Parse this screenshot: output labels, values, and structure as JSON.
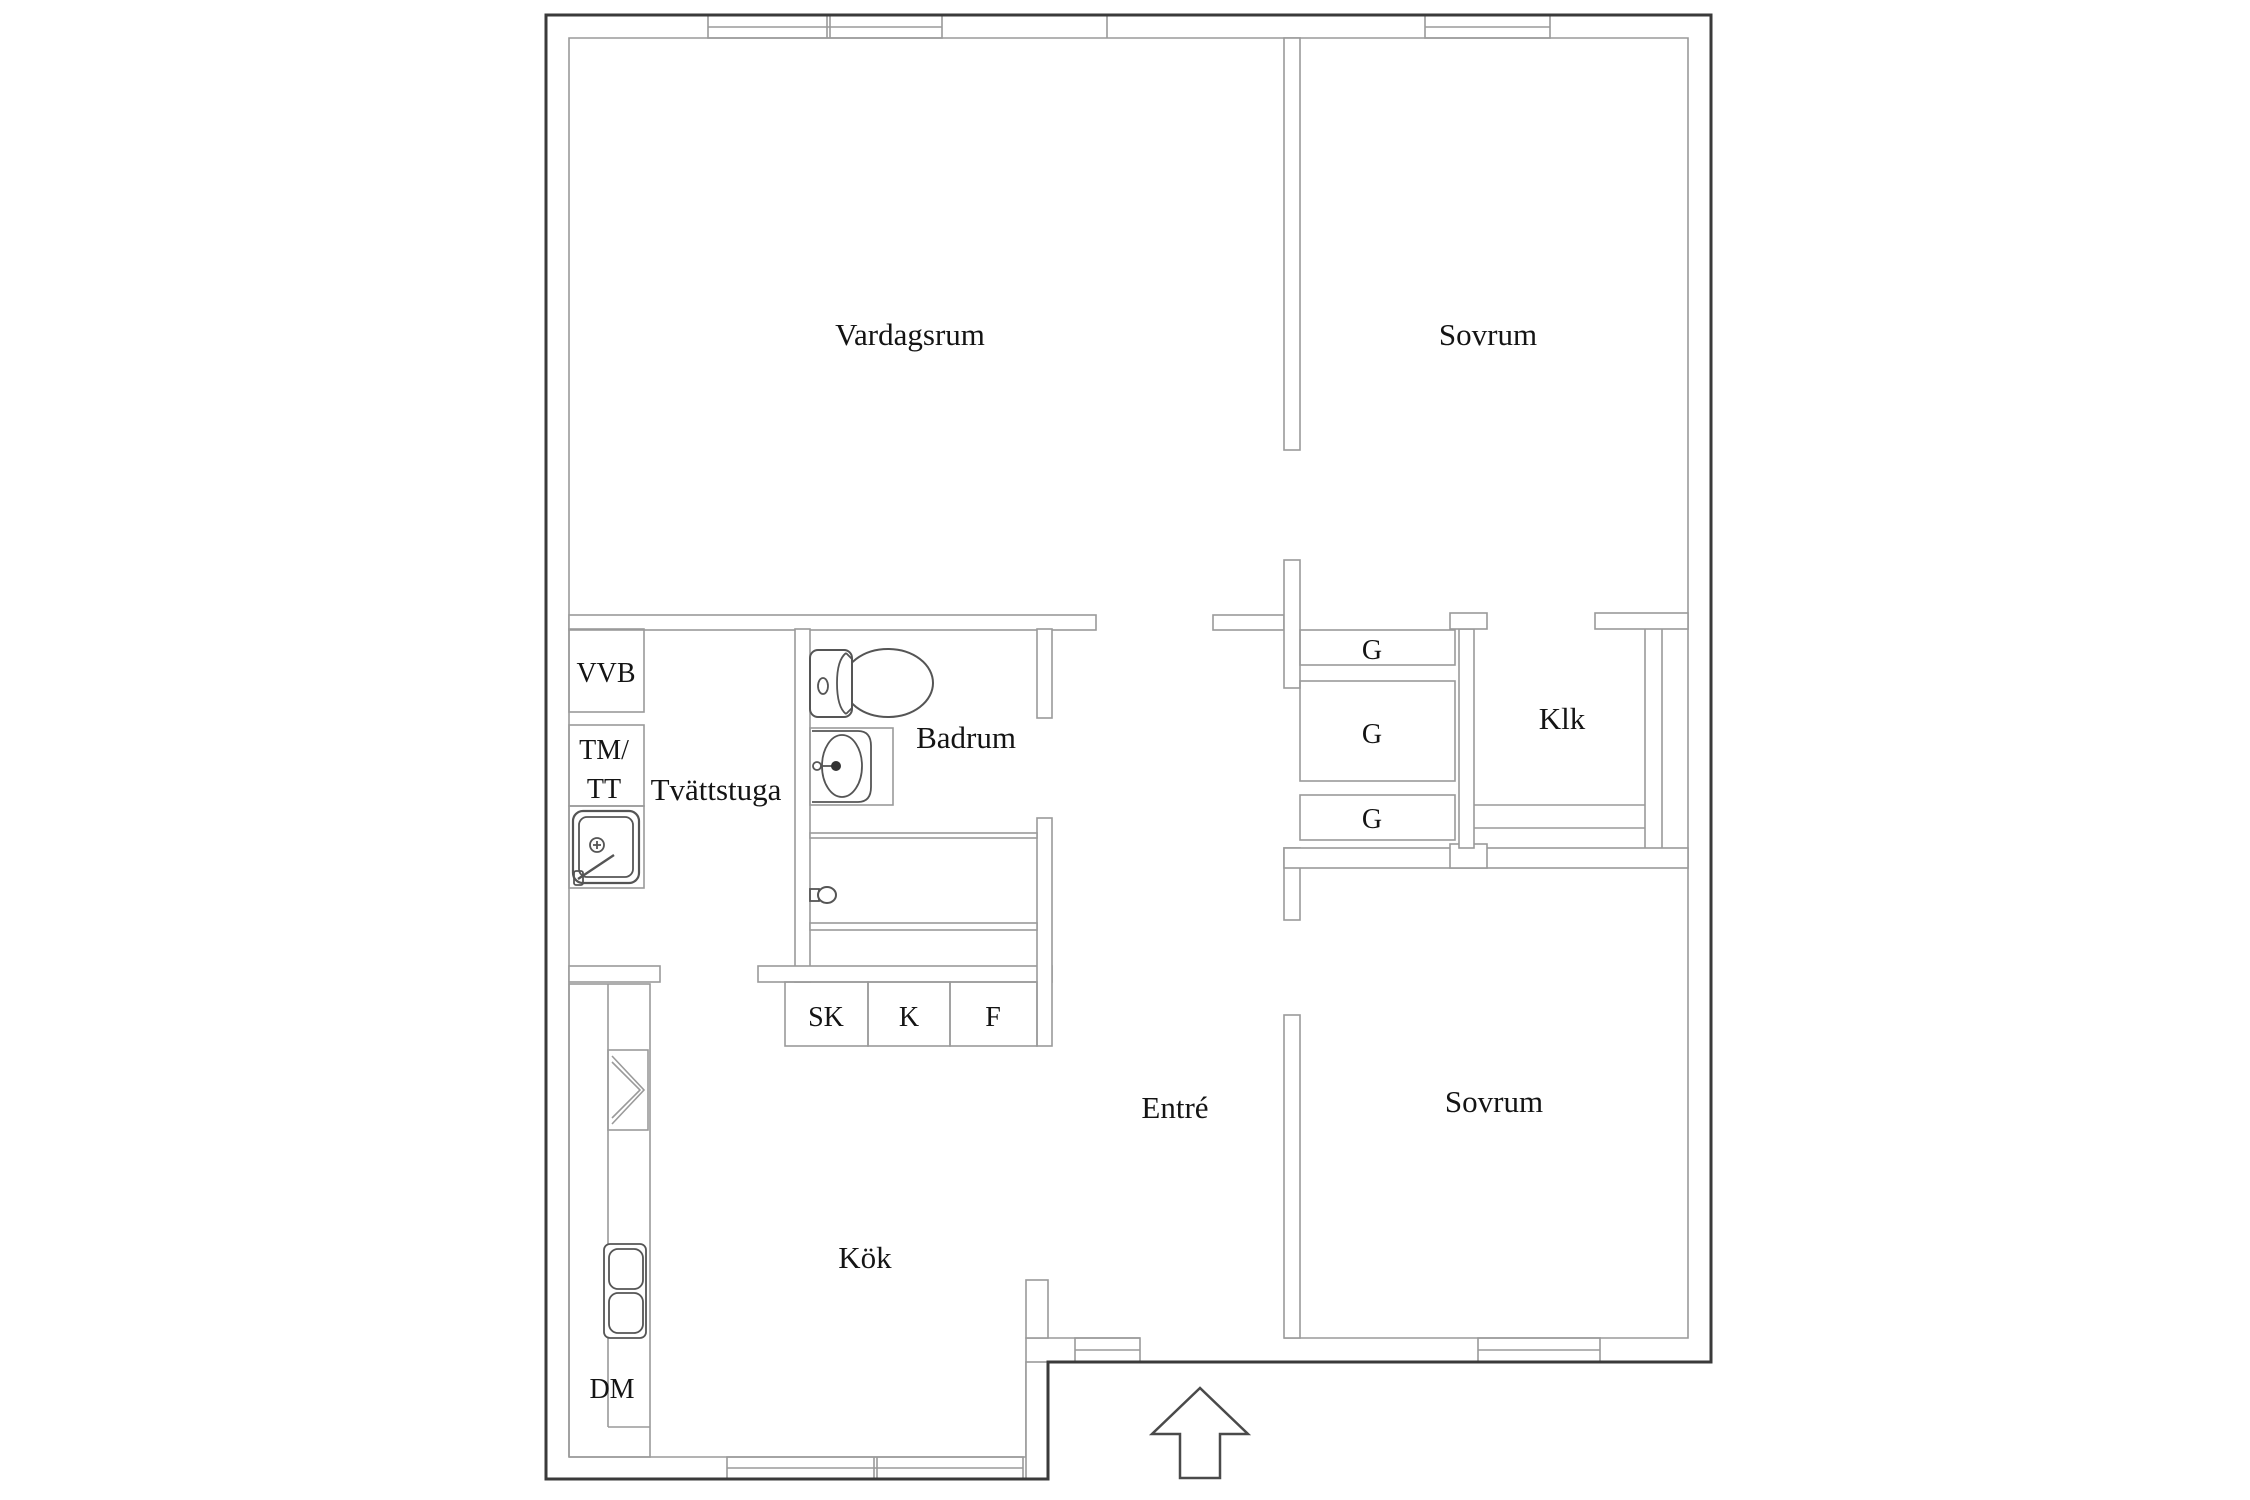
{
  "figure": {
    "type": "apartment-floor-plan",
    "background_color": "#ffffff",
    "outer_wall_color": "#3a3a3a",
    "inner_wall_color": "#9a9a9a",
    "text_color": "#141414"
  },
  "rooms": {
    "vardagsrum": {
      "label": "Vardagsrum"
    },
    "sovrum_top": {
      "label": "Sovrum"
    },
    "sovrum_bottom": {
      "label": "Sovrum"
    },
    "kok": {
      "label": "Kök"
    },
    "entre": {
      "label": "Entré"
    },
    "badrum": {
      "label": "Badrum"
    },
    "tvattstuga": {
      "label": "Tvättstuga"
    },
    "klk": {
      "label": "Klk"
    }
  },
  "storage_and_appliances": {
    "vvb": "VVB",
    "tm": "TM/",
    "tt": "TT",
    "dm": "DM",
    "sk": "SK",
    "k": "K",
    "f": "F",
    "g_top": "G",
    "g_middle": "G",
    "g_bottom": "G"
  },
  "icons": [
    "toilet-icon",
    "bathroom-sink-icon",
    "laundry-sink-icon",
    "kitchen-double-sink-icon",
    "stove-icon",
    "door-handle-icon",
    "entrance-arrow-icon",
    "window-icon"
  ]
}
